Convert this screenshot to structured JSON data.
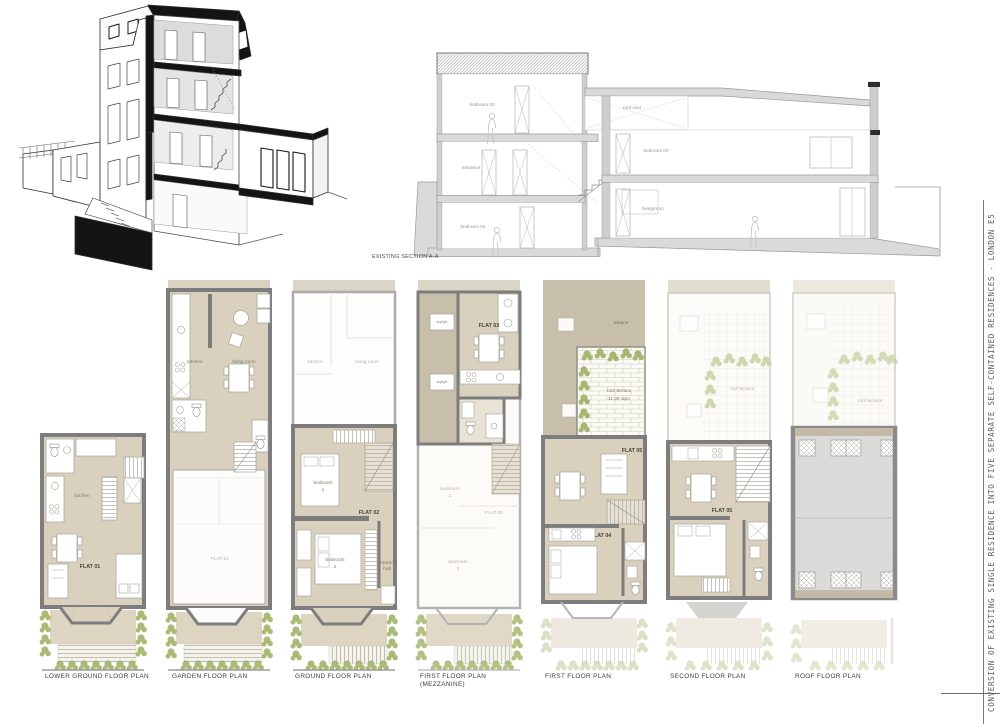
{
  "titleblock": {
    "project": "CONVERSION OF EXISTING SINGLE RESIDENCE INTO FIVE SEPARATE SELF-CONTAINED RESIDENCES - LONDON E5"
  },
  "section": {
    "title": "EXISTING SECTION A-A",
    "labels": {
      "bedroom02": "bedroom 02",
      "roofvoid": "roof void",
      "entrance": "entrance",
      "bedroom03": "bedroom 03",
      "bedroom01": "bedroom 01",
      "livingroom": "livingroom"
    }
  },
  "plans": [
    {
      "title": "LOWER GROUND FLOOR PLAN",
      "subtitle": "",
      "rooms": {
        "kitchen": "kitchen",
        "flat": "FLAT 01"
      }
    },
    {
      "title": "GARDEN FLOOR PLAN",
      "subtitle": "",
      "rooms": {
        "kitchen": "kitchen",
        "living": "living room",
        "flat": "FLAT 01"
      }
    },
    {
      "title": "GROUND FLOOR PLAN",
      "subtitle": "",
      "rooms": {
        "kitchen": "kitchen",
        "living": "living room",
        "bed1a": "bedroom",
        "bed1b": "1",
        "flat": "FLAT 02",
        "bed2a": "bedroom",
        "bed2b": "2",
        "halla": "entrance",
        "hallb": "hall"
      }
    },
    {
      "title": "FIRST FLOOR PLAN",
      "subtitle": "(MEZZANINE)",
      "rooms": {
        "sky1": "skylight",
        "sky2": "skylight",
        "flat": "FLAT 03",
        "bed1a": "bedroom",
        "bed1b": "1",
        "flat2": "FLAT 02",
        "bed2a": "bedroom",
        "bed2b": "2"
      }
    },
    {
      "title": "FIRST FLOOR PLAN",
      "subtitle": "",
      "rooms": {
        "terrace": "terrace",
        "rta": "roof terrace",
        "rtb": "11.95 sqm",
        "flat5": "FLAT 05",
        "flat4": "FLAT 04"
      }
    },
    {
      "title": "SECOND FLOOR PLAN",
      "subtitle": "",
      "rooms": {
        "rt": "roof terrace",
        "flat": "FLAT 05"
      }
    },
    {
      "title": "ROOF FLOOR PLAN",
      "subtitle": "",
      "rooms": {
        "rt": "roof terrace"
      }
    }
  ],
  "colors": {
    "room_beige": "#d9d1be",
    "taupe": "#c7bfaa",
    "wall_gray": "#7d7d7d",
    "plant_green": "#a2b468",
    "roof_gray": "#d7d7d6",
    "cut_black": "#141414"
  }
}
